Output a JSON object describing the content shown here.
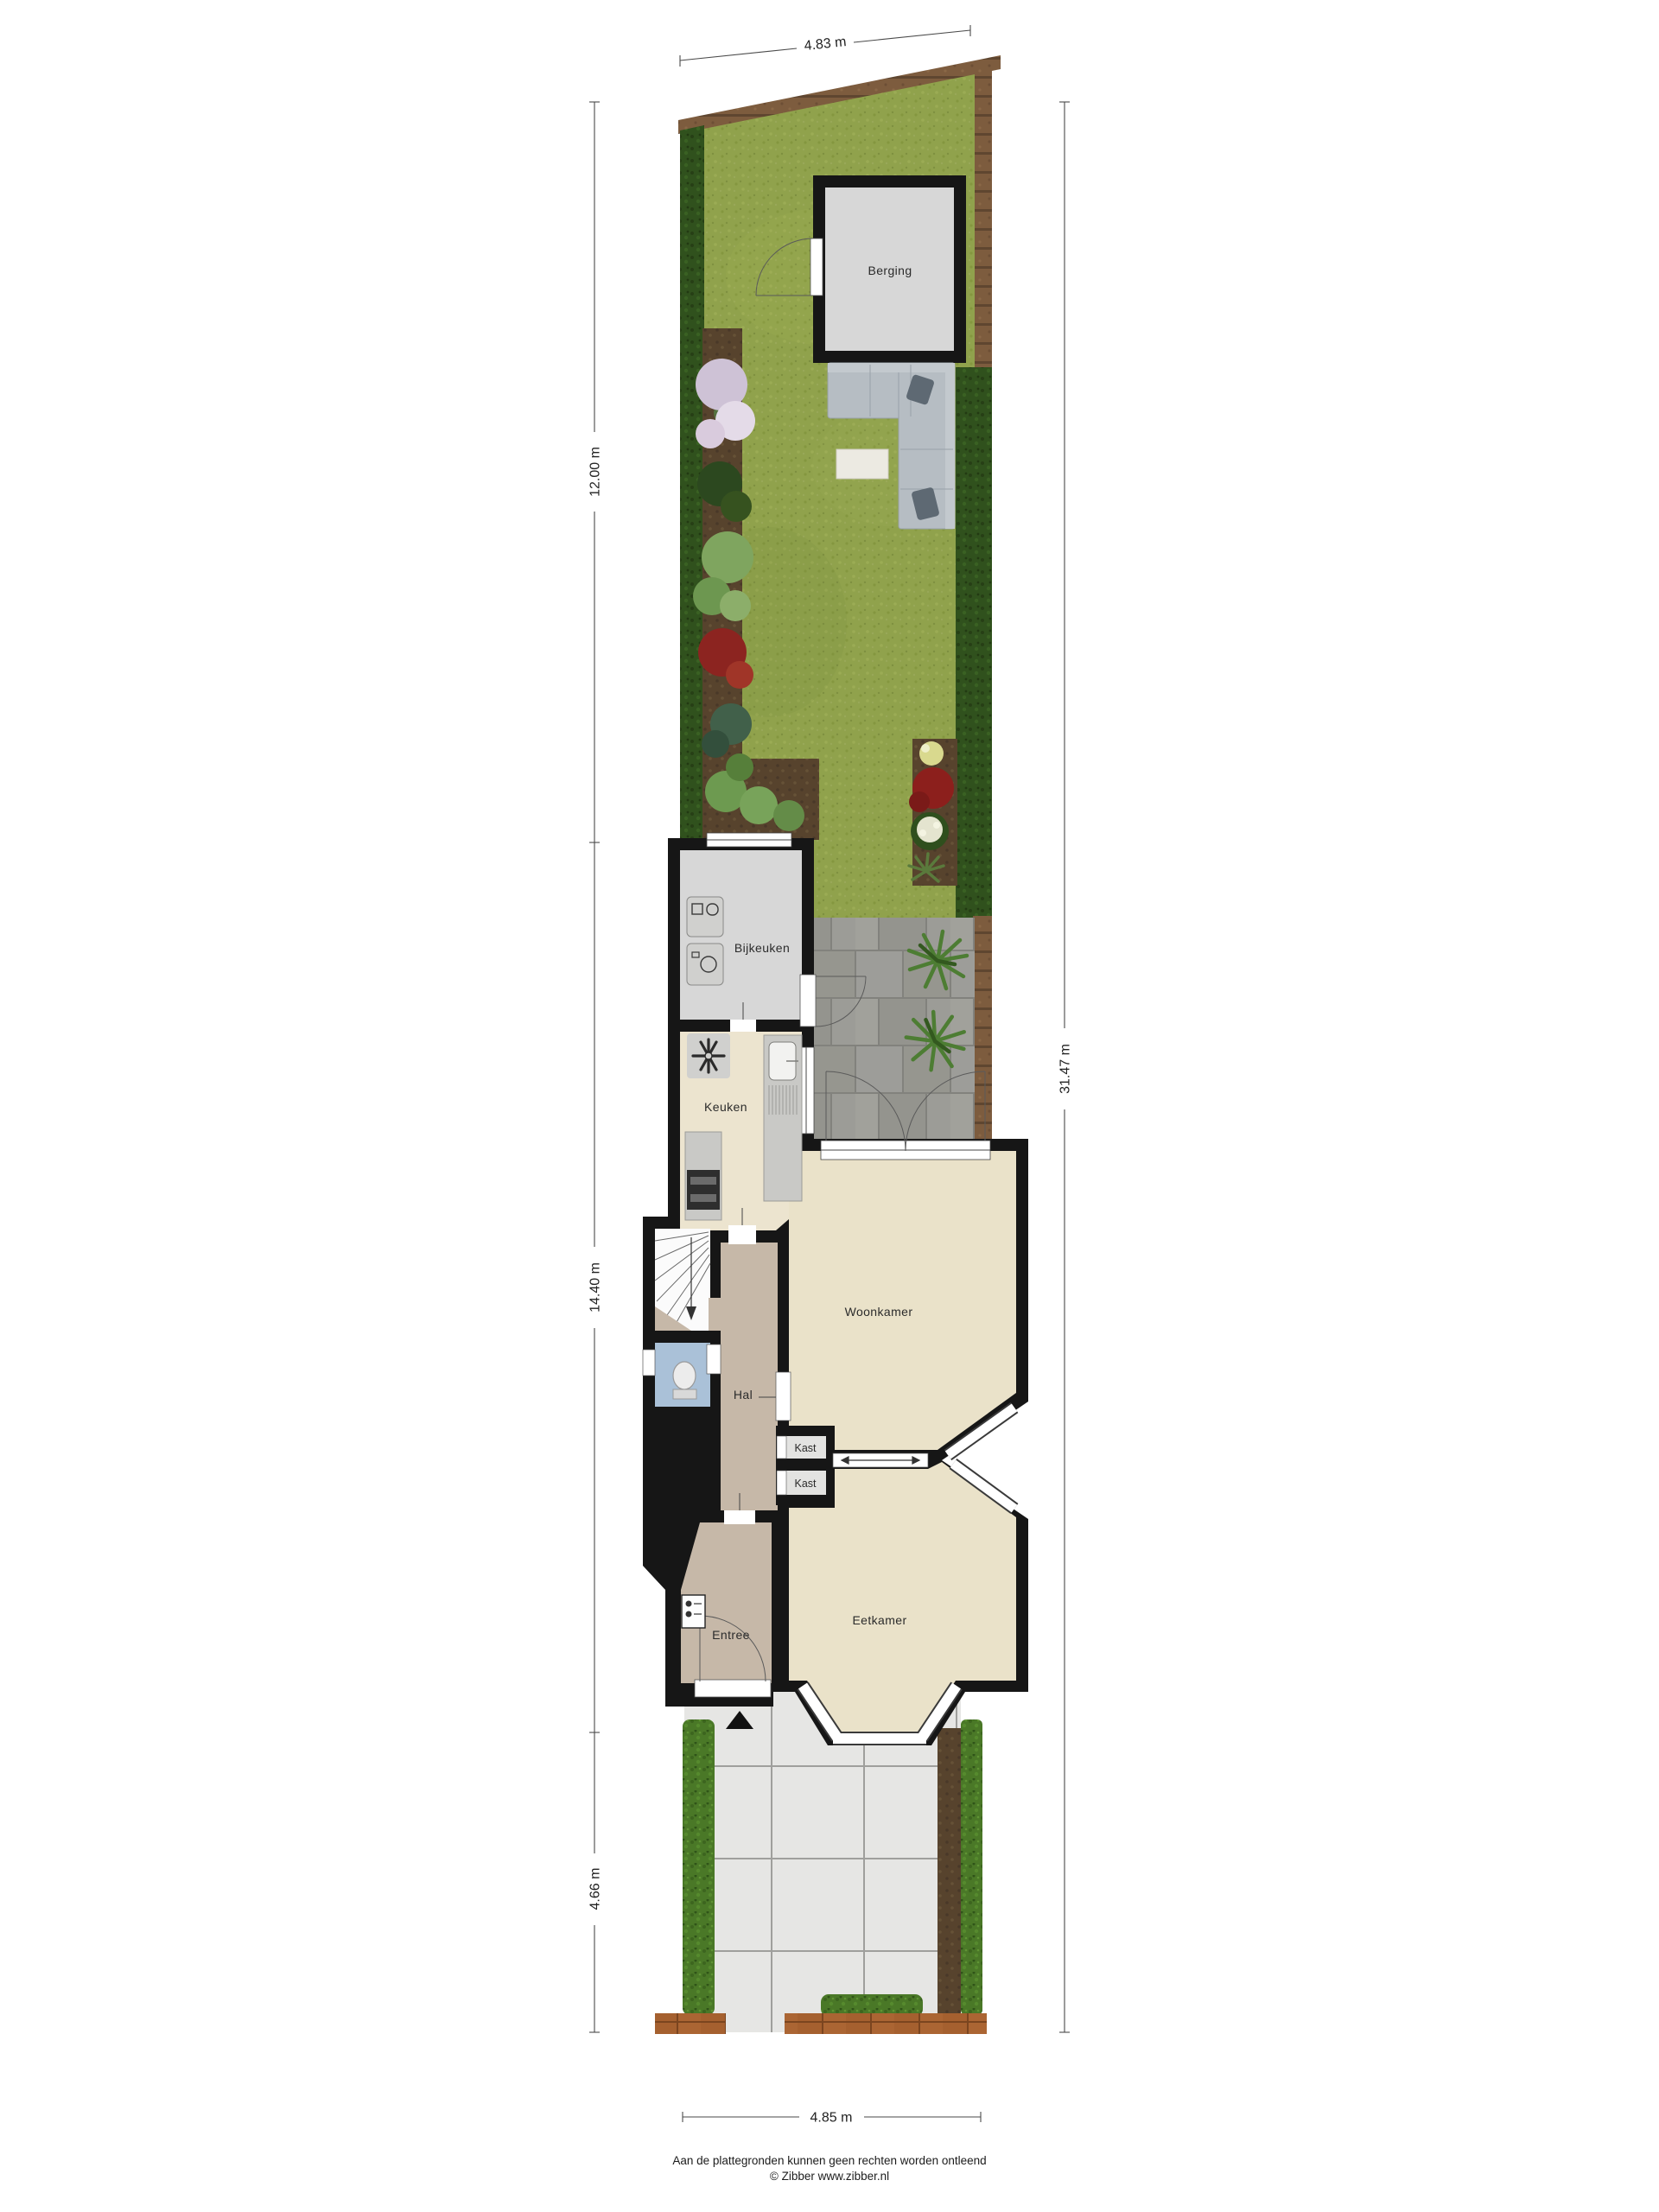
{
  "rooms": {
    "berging": "Berging",
    "bijkeuken": "Bijkeuken",
    "keuken": "Keuken",
    "woonkamer": "Woonkamer",
    "hal": "Hal",
    "kast_top": "Kast",
    "kast_bottom": "Kast",
    "eetkamer": "Eetkamer",
    "entree": "Entree"
  },
  "dimensions": {
    "top_width": "4.83 m",
    "garden_depth": "12.00 m",
    "house_depth": "14.40 m",
    "front_yard_depth": "4.66 m",
    "total_depth": "31.47 m",
    "bottom_width": "4.85 m"
  },
  "footer": {
    "disclaimer": "Aan de plattegronden kunnen geen rechten worden ontleend",
    "copyright": "© Zibber www.zibber.nl"
  },
  "colors": {
    "wall": "#161616",
    "grass": "#90a24c",
    "hedge": "#4a7827",
    "hedge_dark": "#30511d",
    "fence": "#7d5c3e",
    "soil": "#57432d",
    "terrace_paving": "#9a9a95",
    "front_tiles": "#e6e6e4",
    "brick": "#a5602f",
    "living_floor": "#eae2c9",
    "kitchen_floor": "#ece4cf",
    "hall_floor": "#c6b8a8",
    "utility_floor": "#d7d7d7",
    "toilet_floor": "#aac1d8",
    "closet_floor": "#e3e3e1"
  }
}
